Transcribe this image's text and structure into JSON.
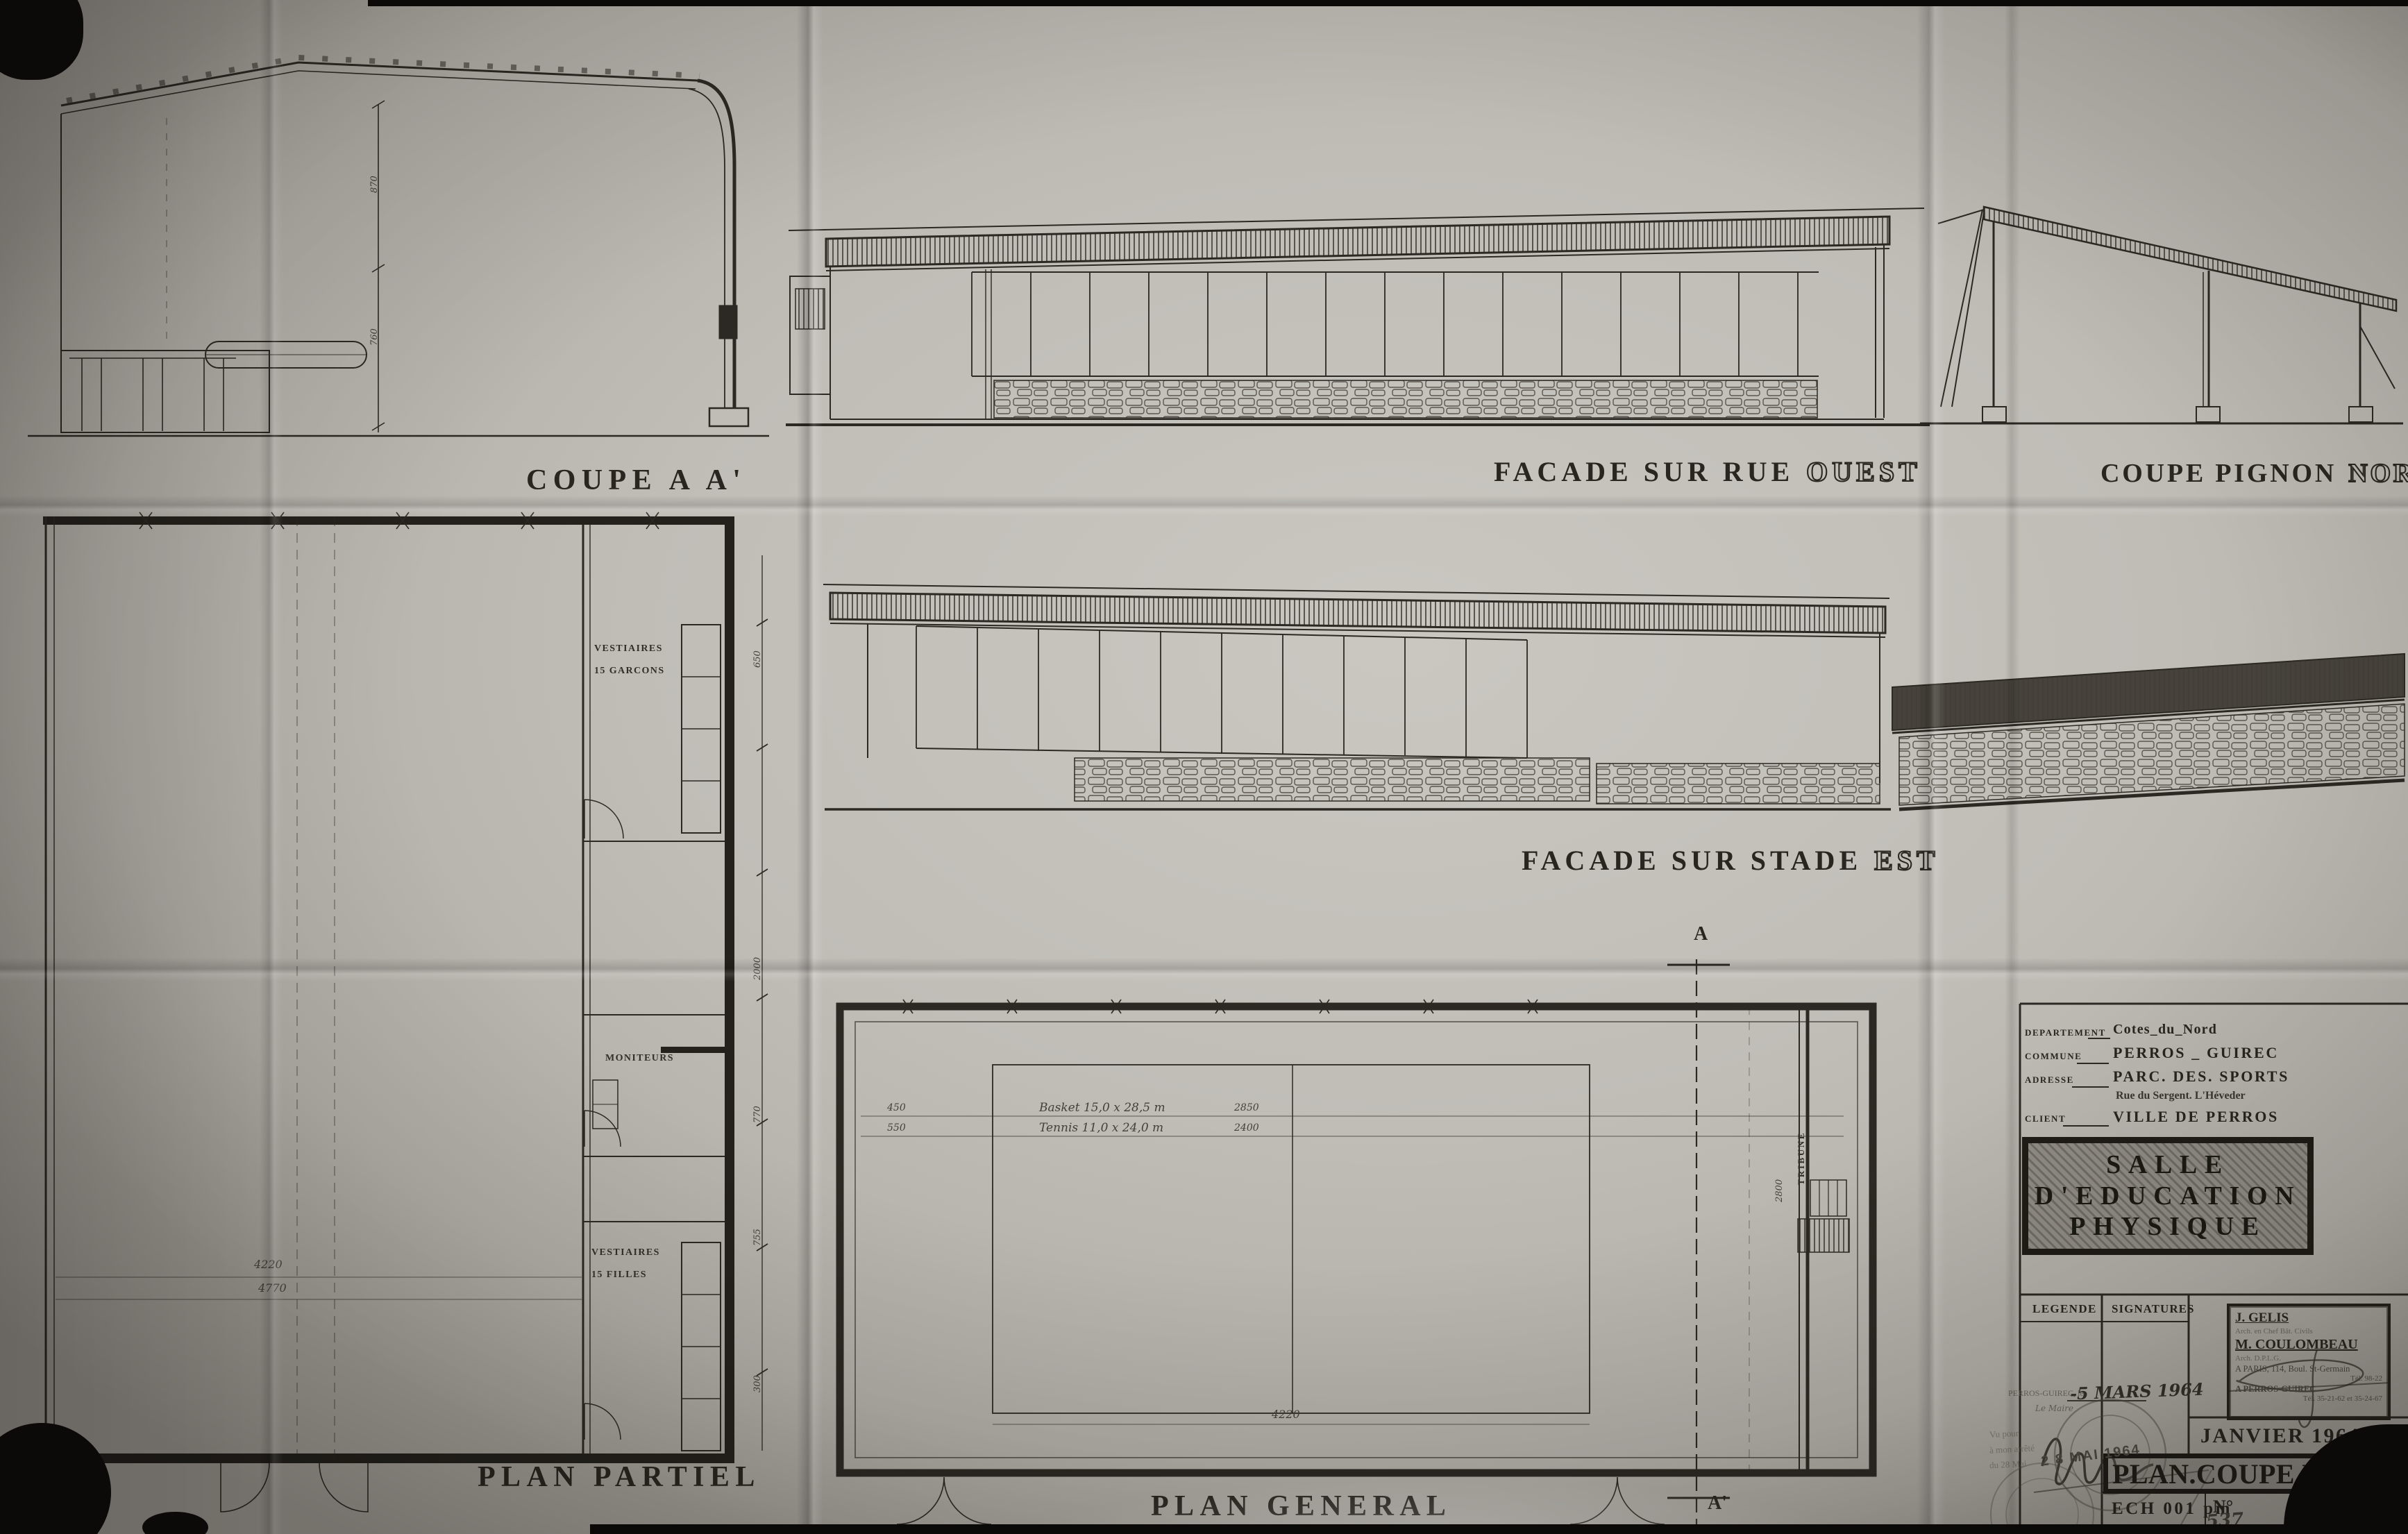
{
  "labels": {
    "coupe_aa": "COUPE A A'",
    "facade_ouest_main": "FACADE SUR RUE",
    "facade_ouest_accent": "OUEST",
    "coupe_pignon_main": "COUPE PIGNON",
    "coupe_pignon_accent": "NORD",
    "facade_est_main": "FACADE SUR STADE",
    "facade_est_accent": "EST",
    "plan_partiel": "PLAN PARTIEL",
    "plan_general": "PLAN GENERAL"
  },
  "coupe": {
    "dim_a": "870",
    "dim_b": "760"
  },
  "partiel": {
    "room1a": "VESTIAIRES",
    "room1b": "15 GARCONS",
    "room2": "MONITEURS",
    "room3a": "VESTIAIRES",
    "room3b": "15 FILLES",
    "dim_a": "4220",
    "dim_b": "4770",
    "side_dims": [
      "650",
      "2000",
      "770",
      "755",
      "300"
    ]
  },
  "general": {
    "marker_top": "A",
    "marker_bottom": "A'",
    "tribune": "TRIBUNE",
    "tribune_dim": "2800",
    "bottom_dim": "4220",
    "rows": [
      {
        "left": "450",
        "label": "Basket  15,0 x 28,5 m",
        "right": "2850"
      },
      {
        "left": "550",
        "label": "Tennis  11,0 x 24,0 m",
        "right": "2400"
      }
    ]
  },
  "tb": {
    "fields": [
      {
        "label": "DEPARTEMENT",
        "value": "Cotes_du_Nord"
      },
      {
        "label": "COMMUNE",
        "value": "PERROS _ GUIREC"
      },
      {
        "label": "ADRESSE",
        "value": "PARC. DES. SPORTS"
      },
      {
        "label": "CLIENT",
        "value": "VILLE DE PERROS"
      }
    ],
    "address_line2": "Rue du Sergent. L'Héveder",
    "title": [
      "SALLE",
      "D'EDUCATION",
      "PHYSIQUE"
    ],
    "legende": "LEGENDE",
    "signatures": "SIGNATURES",
    "arch": {
      "name1": "J. GELIS",
      "role1": "Arch. en Chef Bât. Civils",
      "name2": "M. COULOMBEAU",
      "role2": "Arch. D.P.L.G.",
      "addr1": "A PARIS, 114, Boul. St-Germain",
      "tel1": "Tél. 98-22",
      "addr2": "A PERROS-GUIREC",
      "tel2": "Tél. 35-21-62 et 35-24-67"
    },
    "date": "JANVIER 1964",
    "sheet_title": "PLAN.COUPE.ELEVA",
    "scale": "ECH  001 pm",
    "num_label": "N°",
    "num_hand": "537",
    "num_suffix": "/4"
  },
  "stamps": {
    "place": "PERROS-GUIREC, le",
    "date_hand": "-5 MARS 1964",
    "maire": "Le Maire",
    "v1": "Vu pour",
    "v2": "à mon arrêté",
    "v3": "du 28 Mai",
    "date_stamp": "2 8 MAI 1964"
  }
}
